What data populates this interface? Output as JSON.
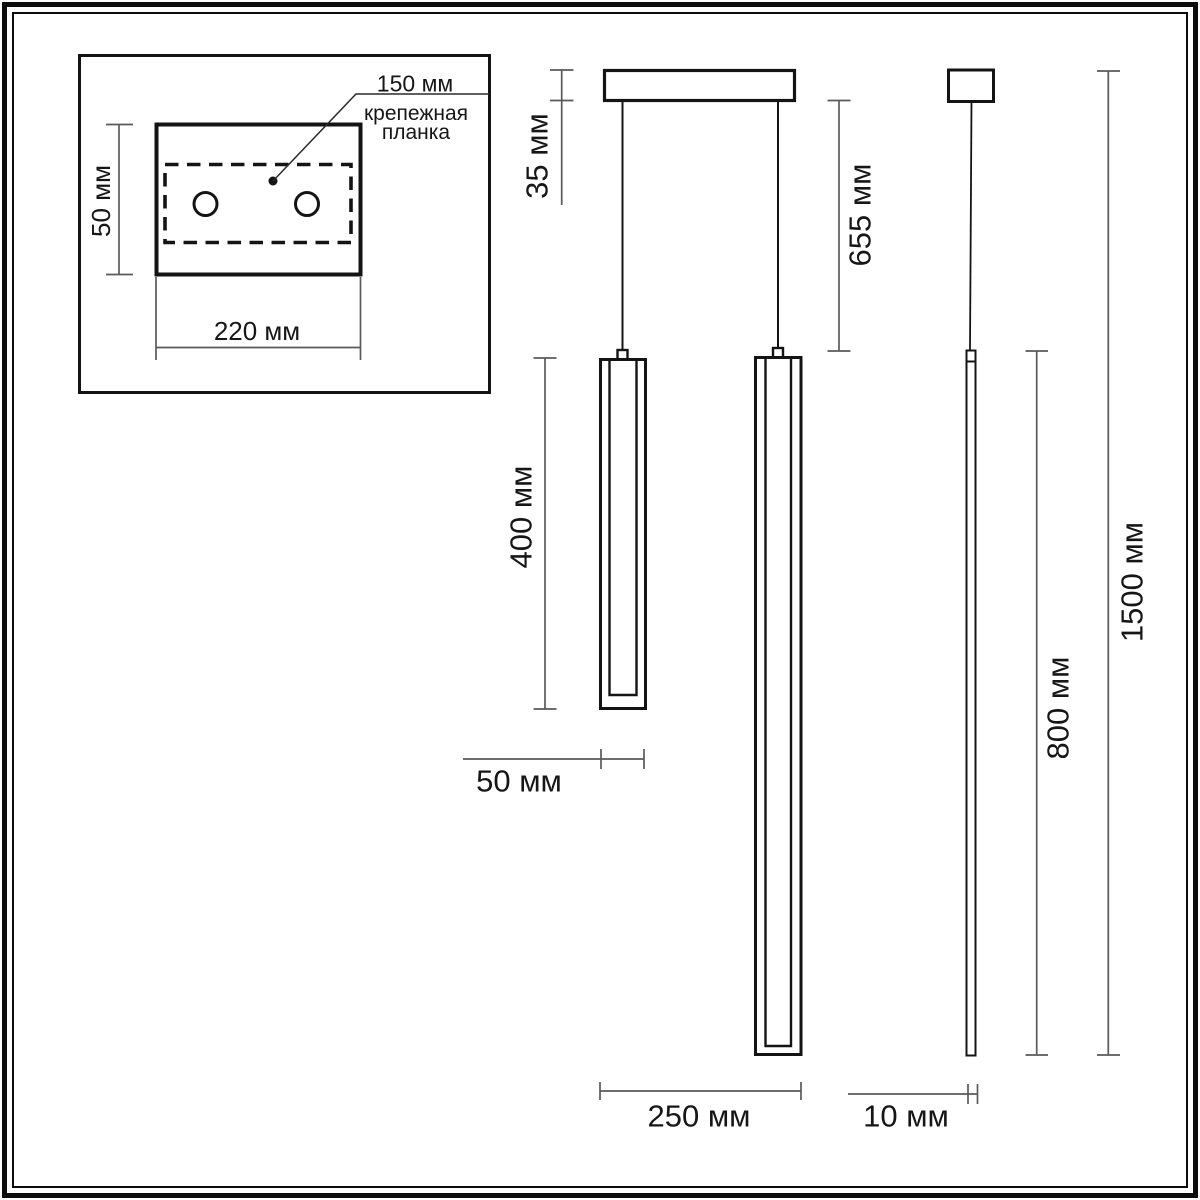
{
  "inset": {
    "hole_spacing_label": "150 мм",
    "callout_line1": "крепежная",
    "callout_line2": "планка",
    "plate_height_label": "50 мм",
    "plate_width_label": "220 мм"
  },
  "pendant": {
    "canopy_height_label": "35 мм",
    "drop_length_label": "655 мм",
    "short_lamp_length_label": "400 мм",
    "short_lamp_width_label": "50 мм",
    "long_lamp_span_label": "250 мм",
    "rod_width_label": "10 мм",
    "rod_length_label": "800 мм",
    "overall_height_label": "1500 мм"
  },
  "colors": {
    "line": "#141414",
    "dimension_line": "#5a5a5a",
    "background": "#ffffff"
  }
}
